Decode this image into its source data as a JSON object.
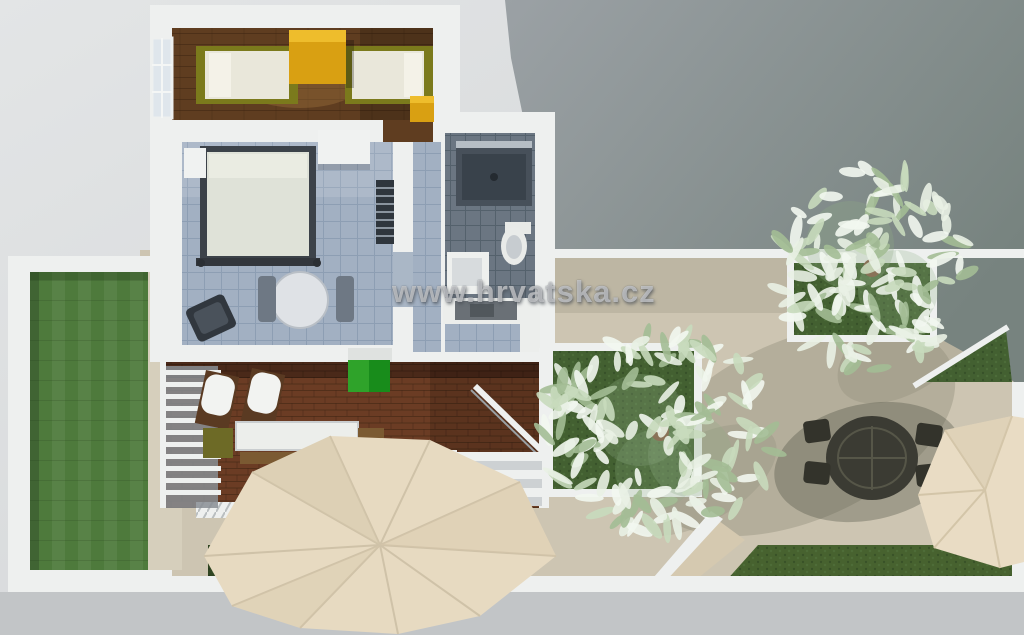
{
  "watermark": {
    "text": "www.hrvatska.cz"
  },
  "palette": {
    "bg": "#d9dbdc",
    "street": "#c2c5c7",
    "wall": "#eef0ef",
    "neighbor_dark": "#77837f",
    "neighbor_light": "#9ba1a5",
    "sand": "#cdc5b2",
    "sand_shadow": "#8e8d79",
    "lawn": "#4e7a3c",
    "path": "#d6cfbc",
    "planter_grass": "#436031",
    "hedge": "#405c2d",
    "deck": "#6b3c24",
    "wood": "#5f3d20",
    "tile": "#a2b0c2",
    "bath_tile": "#6b7682",
    "shower": "#39424b",
    "mat": "#2fa32a",
    "yellow": "#d9a012",
    "yellow_light": "#eebd2c",
    "olive": "#7b7a1c",
    "cream": "#e9e7da",
    "parasol": "#e7dac1",
    "parasol_shade": "#d6c8ab",
    "leaf_light": "#e9f1e4",
    "leaf": "#c8dabc",
    "leaf_dark": "#a3bd95",
    "trunk": "#8a7258",
    "dark_furniture": "#3c4249"
  },
  "trees": [
    {
      "cx": 660,
      "cy": 432,
      "rx": 118,
      "ry": 100,
      "count": 150,
      "seed": 7
    },
    {
      "cx": 872,
      "cy": 268,
      "rx": 100,
      "ry": 102,
      "count": 130,
      "seed": 13
    }
  ]
}
